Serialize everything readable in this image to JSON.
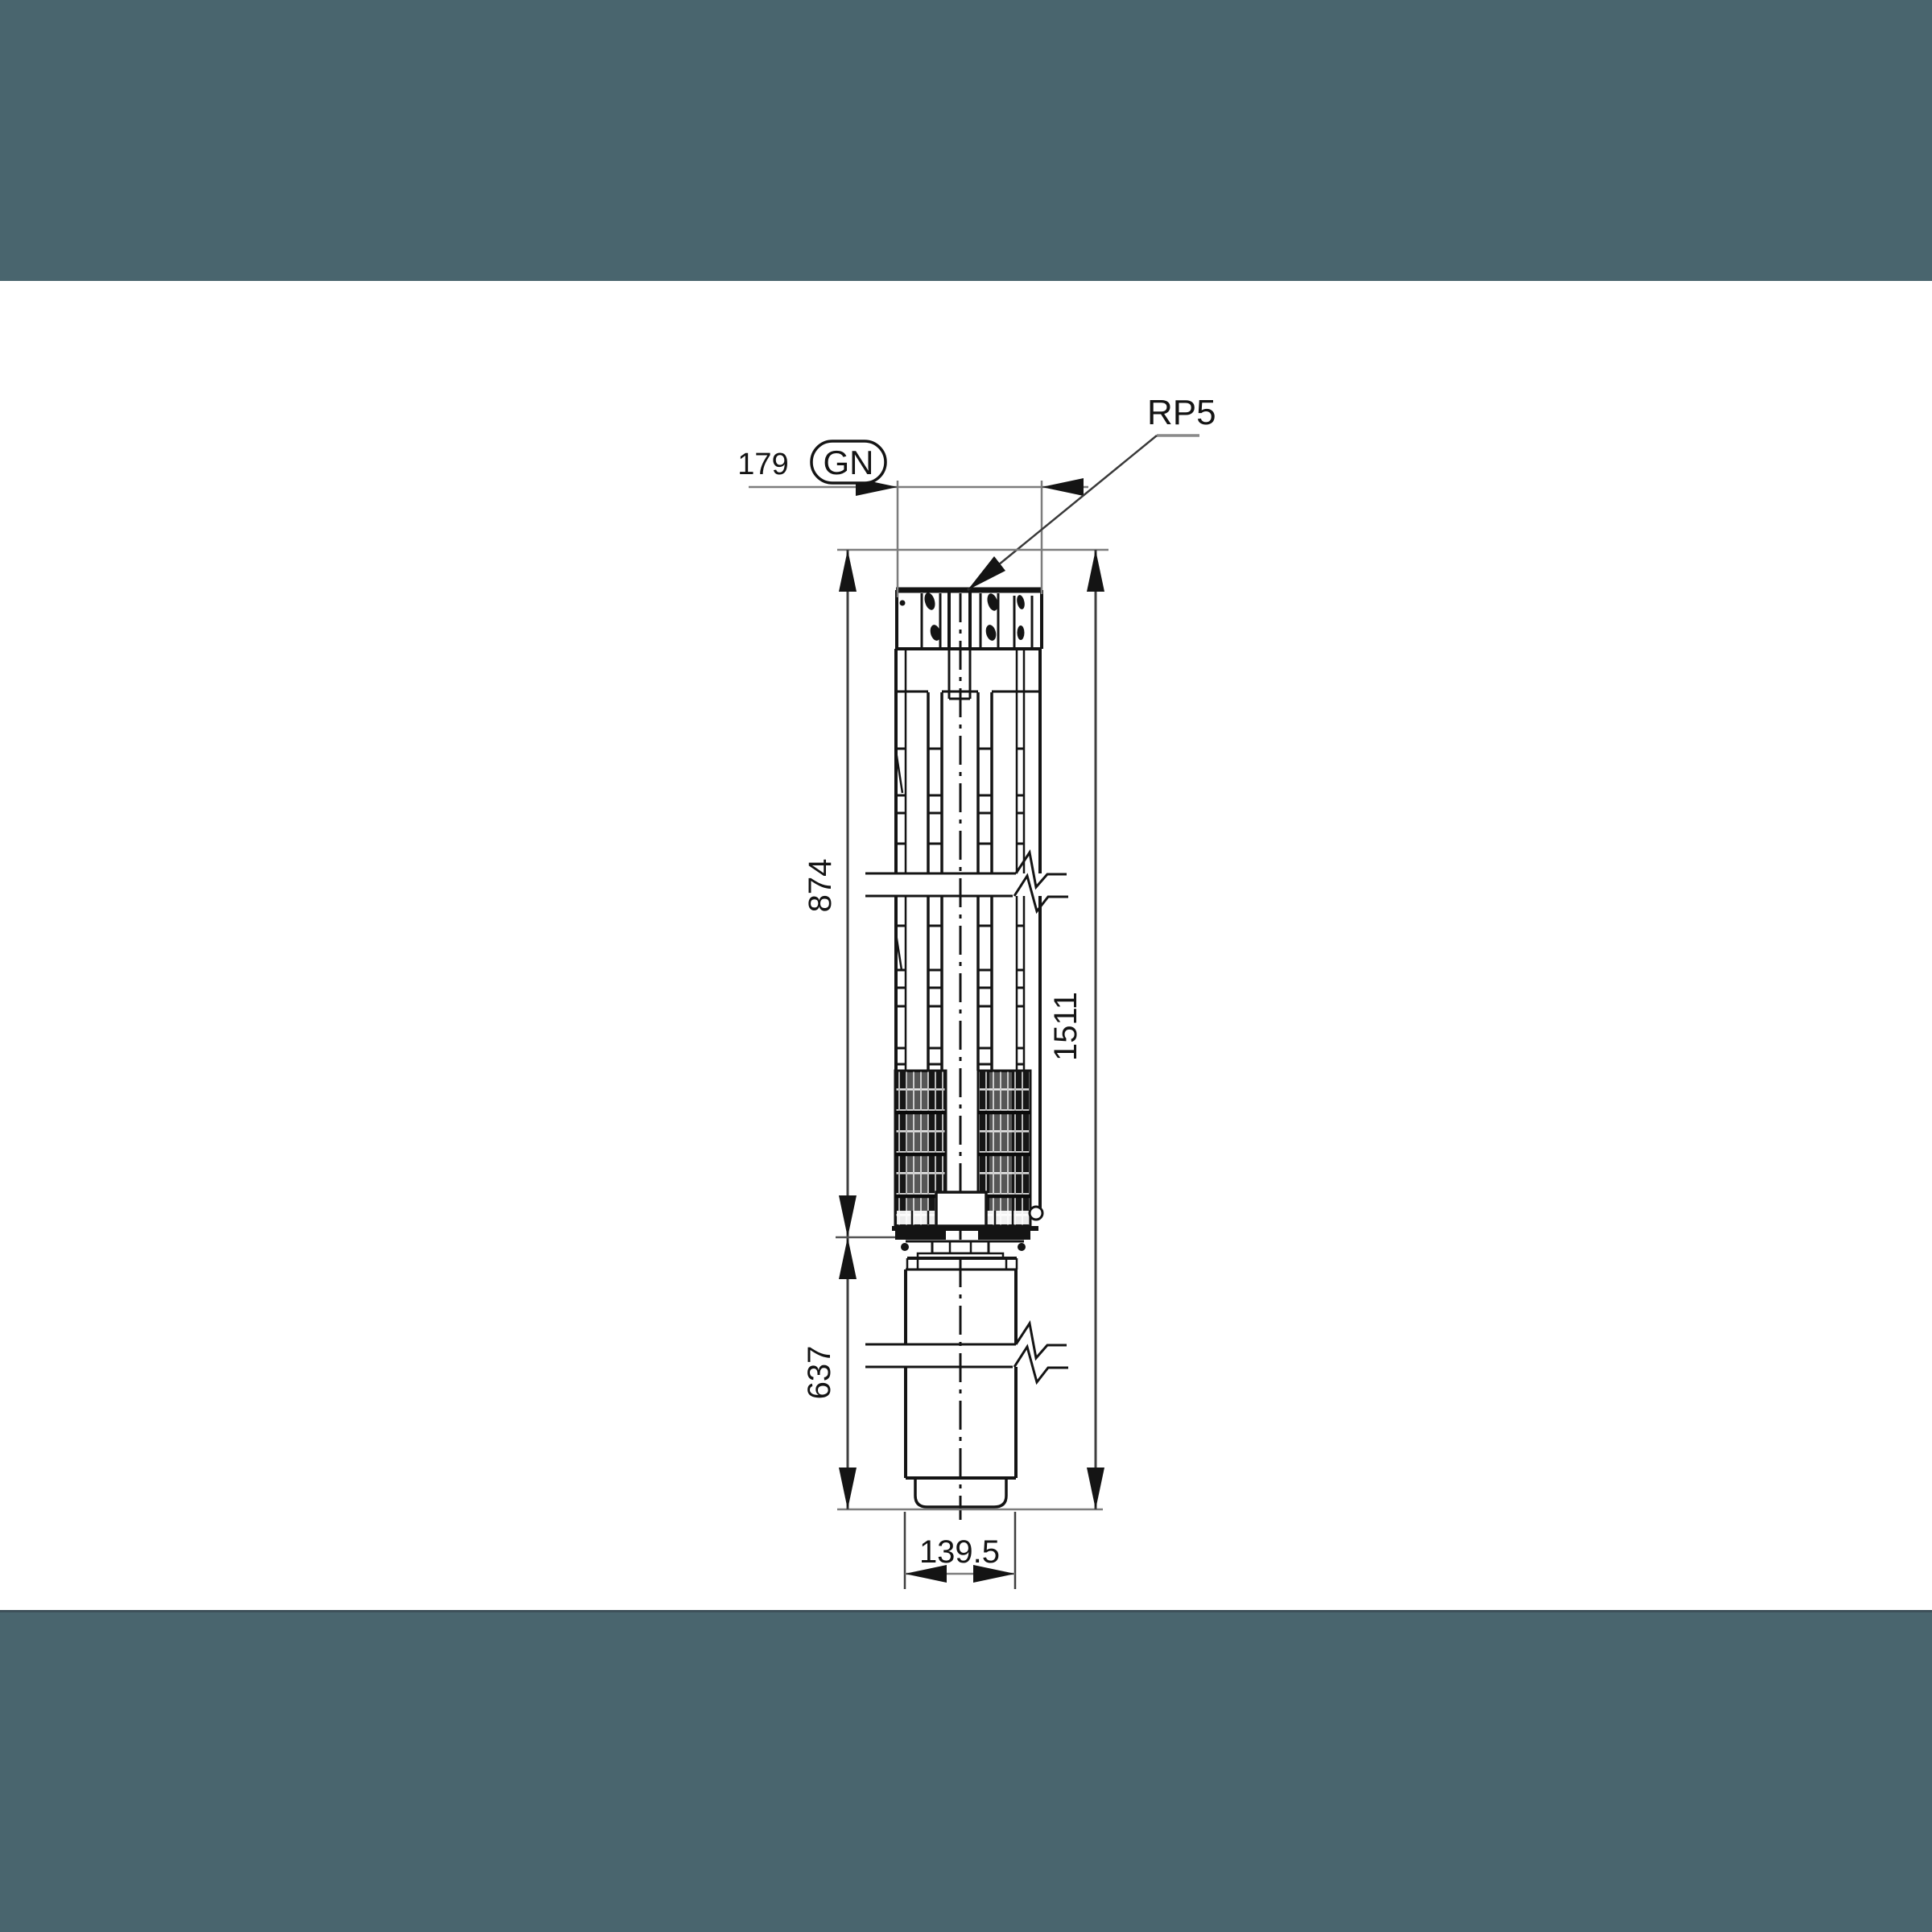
{
  "page": {
    "background": "#ffffff",
    "bands": {
      "color": "#49656e",
      "edge_color": "#3d5059"
    }
  },
  "diagram": {
    "kind": "submersible-pump-dimensional-drawing",
    "ink_color": "#141414",
    "dim_line_color": "#7d7d7d",
    "port_label": "RP5",
    "outlet_badge": "GN",
    "dims": {
      "head_width": "179",
      "pump_end_length": "874",
      "overall_length": "1511",
      "motor_length": "637",
      "motor_diameter": "139.5"
    }
  }
}
